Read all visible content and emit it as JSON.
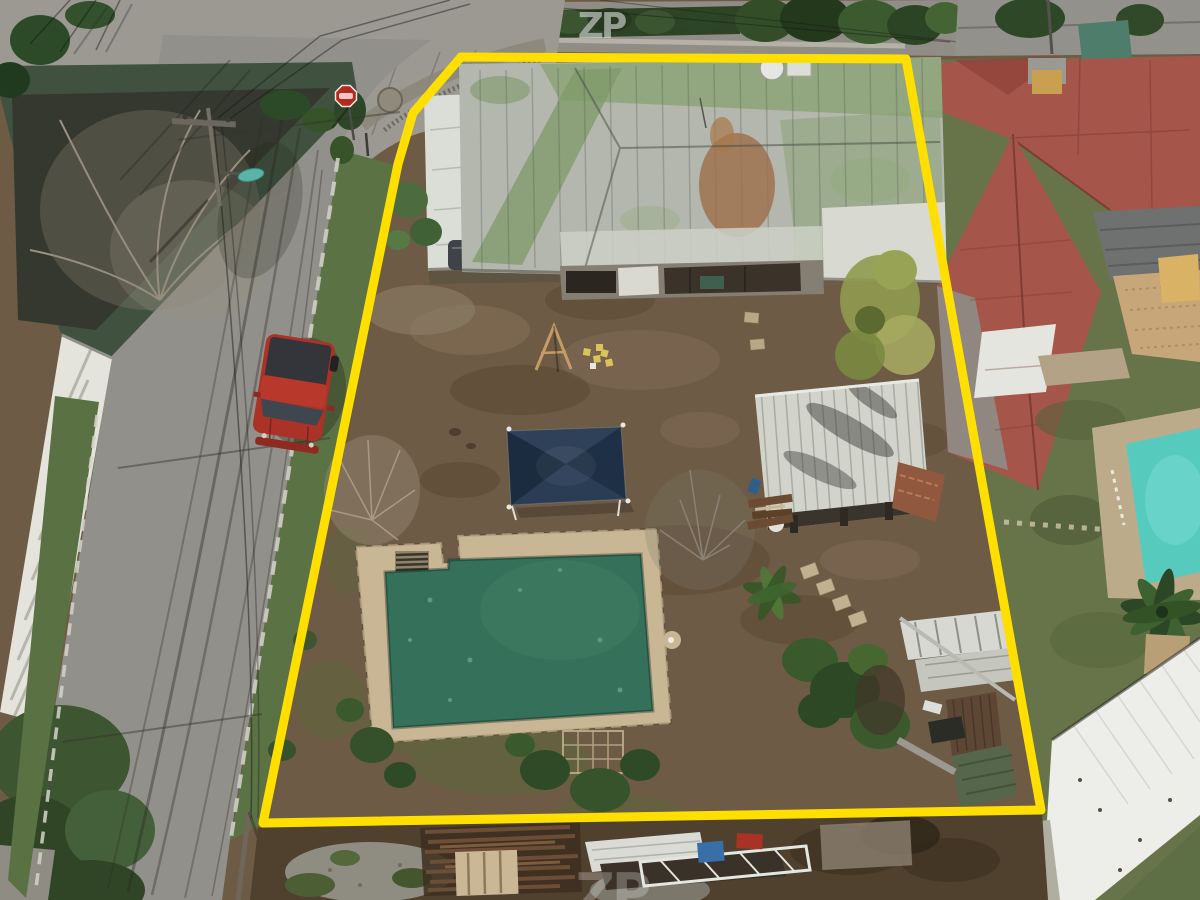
{
  "watermarks": {
    "top": "ZP",
    "bottom": "ZP"
  },
  "colors": {
    "boundary": "#ffdf00",
    "street": "#92908a",
    "dirt": "#6e5b45",
    "grass": "#5b7244",
    "pool_water": "#35705b",
    "pool_deck": "#c8b694",
    "canopy": "#22364f",
    "truck": "#ab3226",
    "stop_sign": "#b5281e",
    "neighbor_roof": "#a6554a",
    "neighbor_pool": "#57cabe",
    "main_roof_metal": "#b3b7ad",
    "main_roof_moss": "#84a06c",
    "shed_roof": "#d2d4cc",
    "streetlight": "#5ab5a8"
  }
}
